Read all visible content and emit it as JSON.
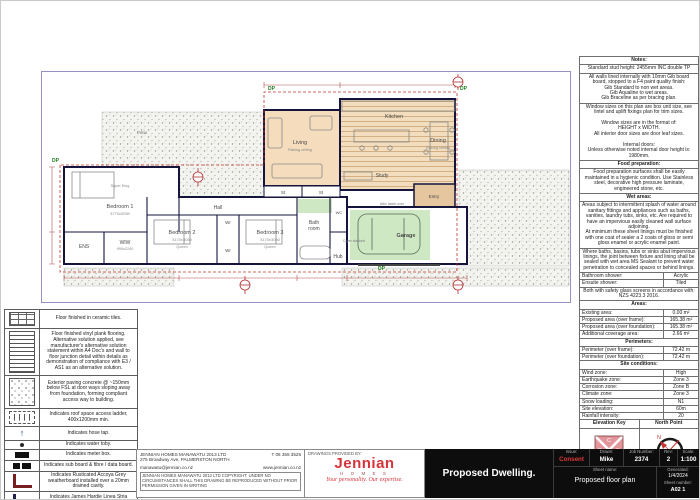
{
  "colors": {
    "jennian_red": "#d6343a",
    "consent_red": "#e03a3a",
    "living_fill": "#f4dcbd",
    "wood_fill": "#f2debe",
    "green_fill": "#cfe8c4",
    "plan_border": "#9b8ec4"
  },
  "plan": {
    "labels": {
      "dp": "DP",
      "patio": "Patio",
      "living": "Living",
      "living_note": "Raking ceiling",
      "kitchen": "Kitchen",
      "dining": "Dining",
      "dining_note": "Raking ceiling",
      "study": "Study",
      "entry": "Entry",
      "st1": "St",
      "st2": "St",
      "garage": "Garage",
      "attic": "Attic hatch over",
      "dryer": "Dryer stacked",
      "bedroom1": "Bedroom 1",
      "bedroom1_size": "3770x3050",
      "bedroom1_bed": "Super King",
      "ens": "ENS",
      "wiw": "WIW",
      "wiw_size": "990x2240",
      "bedroom2": "Bedroom 2",
      "bedroom2_size": "3170x3050",
      "bedroom2_bed": "Queen",
      "bedroom3": "Bedroom 3",
      "bedroom3_size": "3170x3050",
      "bedroom3_bed": "Queen",
      "wr1": "Wr",
      "wr2": "Wr",
      "hall": "Hall",
      "bath_l1": "Bath",
      "bath_l2": "room",
      "wc": "WC",
      "hub": "Hub"
    }
  },
  "notes": {
    "title": "Notes:",
    "stud": "Standard stud height: 2455mm INC double TP",
    "gib": "All walls lined internally with 10mm Gib board board, stopped to a F4 paint quality finish:\nGib Standard to non wet areas.\nGib Aqualine to wet areas.\nGib Braceline as per bracing plan.",
    "windows": "Window sizes on this plan are box unit size, see lintel and uplift fixings plan for trim sizes.\n\nWindow sizes are in the format of:\nHEIGHT x WIDTH.\nAll interior door sizes are door leaf sizes.\n\nInternal doors:\nUnless otherwise noted internal door height is:\n1980mm.",
    "food_title": "Food preparation:",
    "food": "Food preparation surfaces shall be easily maintained in a hygienic condition. Use Stainless steel, decorative high pressure laminate, engineered stone, etc.",
    "wet_title": "Wet areas:",
    "wet1": "Areas subject to intermittent splash of water around sanitary fittings and appliances such as baths, vanities, laundry tubs, sinks, etc. Are required to have an impervious easily cleaned wall surface adjoining.\nAt minimum these sheet linings must be finished with one coat of sealer a 2 coats of gloss or semi gloss enamel or acrylic enamel paint.",
    "wet2": "Where baths, basins, tubs or sinks abut impervious linings, the joint between fixture and lining shall be sealed with wet area MS Sealant to prevent water penetration to concealed spaces or behind linings.",
    "shower": [
      {
        "label": "Bathroom shower:",
        "value": "Acrylic"
      },
      {
        "label": "Ensuite shower:",
        "value": "Tiled"
      }
    ],
    "glass": "Both with safety glass screens in accordance with: NZS 4223.3 2016.",
    "areas_title": "Areas:",
    "areas": [
      {
        "label": "Existing area:",
        "value": "0.00 m²"
      },
      {
        "label": "Proposed area (over frame):",
        "value": "165.38 m²"
      },
      {
        "label": "Proposed area (over foundation):",
        "value": "165.38 m²"
      },
      {
        "label": "Additional coverage area:",
        "value": "2.66 m²"
      }
    ],
    "perim_title": "Perimeters:",
    "perims": [
      {
        "label": "Perimeter (over frame):",
        "value": "72.42 m"
      },
      {
        "label": "Perimeter (over foundation):",
        "value": "72.42 m"
      }
    ],
    "site_title": "Site conditions:",
    "site": [
      {
        "label": "Wind zone:",
        "value": "High"
      },
      {
        "label": "Earthquake zone:",
        "value": "Zone 3"
      },
      {
        "label": "Corrosion zone:",
        "value": "Zone B"
      },
      {
        "label": "Climate zone:",
        "value": "Zone 3"
      },
      {
        "label": "Snow loading:",
        "value": "N1"
      },
      {
        "label": "Site elevation:",
        "value": "60m"
      },
      {
        "label": "Rainfall intensity:",
        "value": "20"
      }
    ],
    "elev_title": "Elevation Key",
    "north_title": "North Point",
    "elev": {
      "top": "C",
      "left": "D",
      "right": "B",
      "bottom": "A"
    },
    "north_n": "N"
  },
  "legend": {
    "items": [
      {
        "text": "Floor finished in ceramic tiles."
      },
      {
        "text": "Floor finished vinyl plank flooring. Alternative solution applied, see manufacturer's alternative solution statement within A4 Doc's and wall to floor junction detail within details as demonstration of compliance with E3 / AS1 as an alternative solution."
      },
      {
        "text": "Exterior paving concrete @ ~150mm below FSL at door ways sloping away from foundation, forming compliant access way to building."
      },
      {
        "text": "Indicates roof space access ladder, 400x1200mm min."
      },
      {
        "text": "Indicates hose tap."
      },
      {
        "text": "Indicates water toby."
      },
      {
        "text": "Indicates meter box."
      },
      {
        "text": "Indicates sub board & fibre / data board."
      },
      {
        "text": "Indicates Rusticated Accoya Grey weatherboard installed over a 20mm drained cavity."
      },
      {
        "text": "Indicates James Hardie Linea Stria weatherboard cladding on a 20mm cavity."
      }
    ]
  },
  "provider": {
    "company": "JENNIAN HOMES MANAWATU 2013 LTD",
    "address": "275 Broadway Ave, PALMERSTON NORTH",
    "phone": "T 06 355 3525",
    "email": "manawatu@jennian.co.nz",
    "web": "www.jennian.co.nz",
    "copyright": "JENNIAN HOMES MANAWATU 2013 LTD COPYRIGHT: UNDER NO CIRCUMSTANCES SHALL THIS DRAWING BE REPRODUCED WITHOUT PRIOR PERMISSION GIVEN IN WRITING",
    "provided_by": "DRAWINGS PROVIDED BY:",
    "logo": "Jennian",
    "logo_sub": "H O M E S",
    "tagline": "Your personality. Our expertise."
  },
  "titleblock": {
    "title": "Proposed Dwelling.",
    "issue_label": "Issue:",
    "issue": "Consent",
    "drawn_label": "Drawn:",
    "drawn": "Mike",
    "job_label": "Job Number:",
    "job": "2374",
    "rev_label": "Rev:",
    "rev": "2",
    "scale_label": "Scale:",
    "scale": "1:100",
    "sheet_name_label": "Sheet name:",
    "sheet_name": "Proposed floor plan",
    "generated_label": "Generated:",
    "generated": "1/4/2024",
    "sheet_number_label": "Sheet number:",
    "sheet_number": "A02 1"
  }
}
